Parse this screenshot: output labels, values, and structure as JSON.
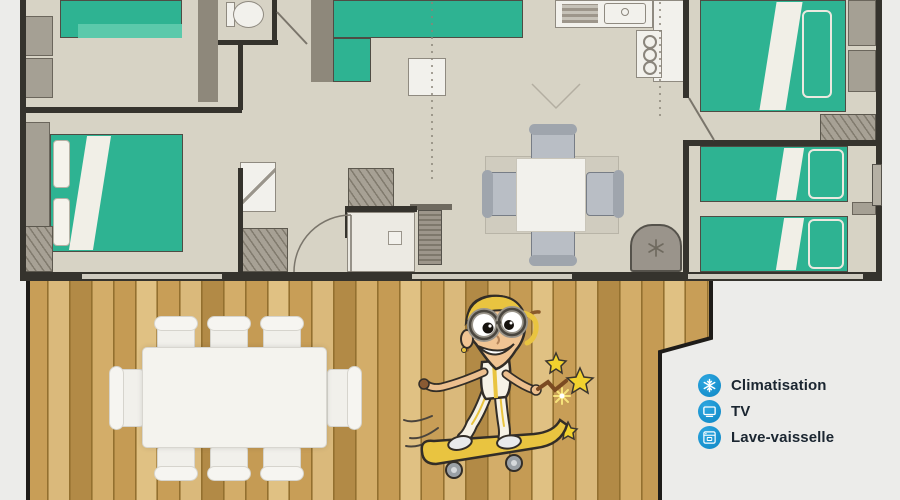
{
  "legend": {
    "items": [
      {
        "icon": "snowflake-icon",
        "label": "Climatisation"
      },
      {
        "icon": "tv-icon",
        "label": "TV"
      },
      {
        "icon": "dishwasher-icon",
        "label": "Lave-vaisselle"
      }
    ],
    "icon_color": "#1190d2",
    "text_color": "#1b2631"
  },
  "palette": {
    "background": "#ececea",
    "plan_floor": "#d7d3c5",
    "wall_dark": "#35332d",
    "wall_gray": "#8e887b",
    "bed_green": "#2eb392",
    "bed_green_light": "#5bc9ab",
    "furniture_gray": "#a5a094",
    "furniture_white": "#f2f1ec",
    "deck_wood": "#c89e57",
    "accent_blue": "#1190d2",
    "mascot_yellow": "#e9c440"
  }
}
